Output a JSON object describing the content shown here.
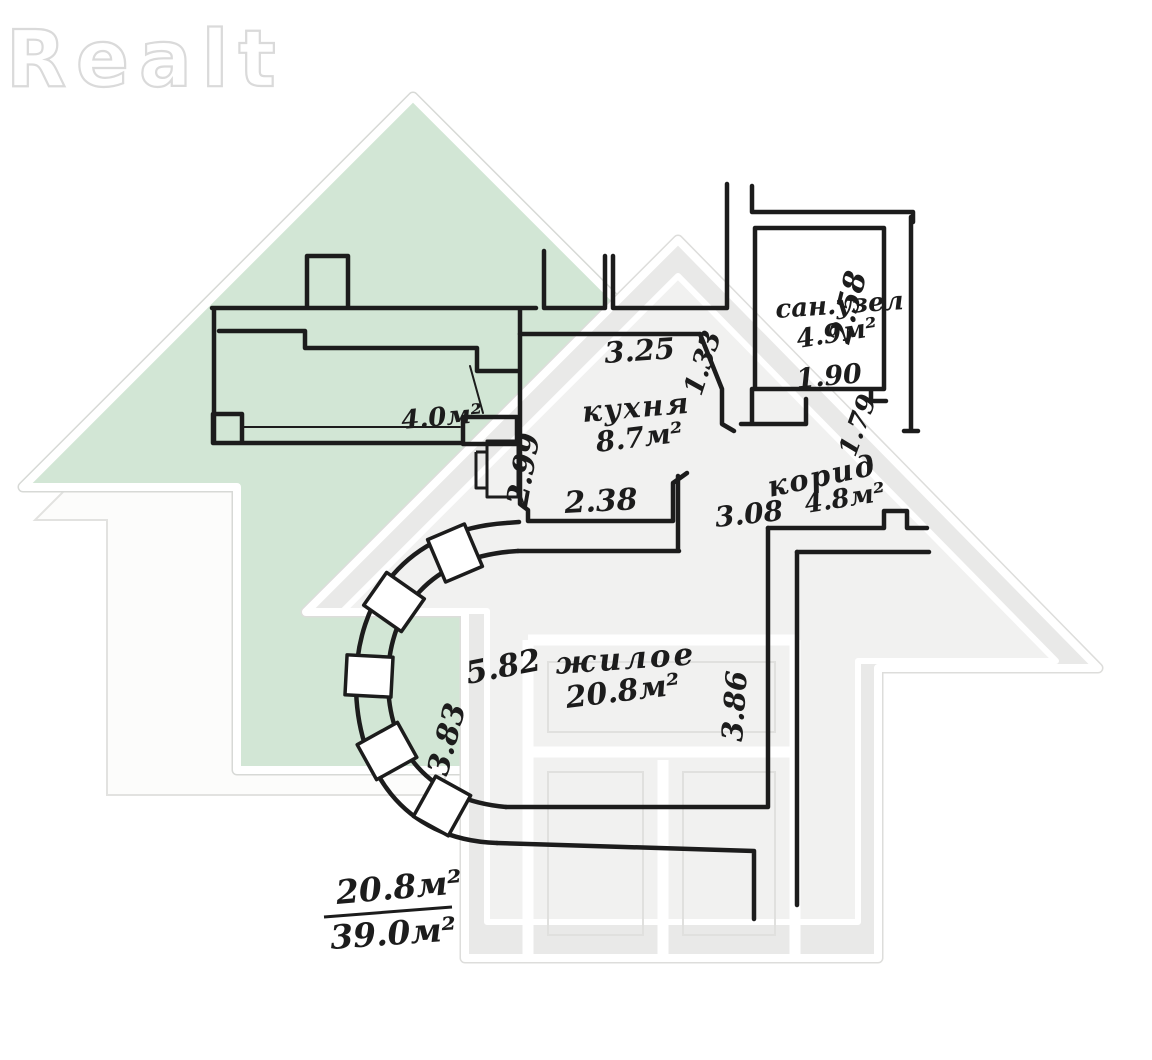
{
  "page": {
    "background": "#ffffff"
  },
  "watermark": {
    "logo_text": "Realt",
    "green_fill": "#d2e6d5",
    "gray_fill": "#e9e9e8",
    "gray_inner_fill": "#f1f1f0",
    "light_fill": "#fcfcfb"
  },
  "plan": {
    "ink_color": "#1c1c1c",
    "balcony": {
      "area": "4.0м²"
    },
    "kitchen": {
      "name": "кухня",
      "area": "8.7м²"
    },
    "bathroom": {
      "name": "сан.узел",
      "area": "4.9м²"
    },
    "corridor": {
      "name": "корид",
      "area": "4.8м²"
    },
    "living": {
      "name": "жилое",
      "area": "20.8м²"
    },
    "dimensions": {
      "top": "3.25",
      "kitchen_right": "1.33",
      "bath_height": "2.58",
      "bath_door": "1.90",
      "outer_right": "1.79",
      "kitchen_left": "2.99",
      "kitchen_bottom": "2.38",
      "corridor_width": "3.08",
      "living_width": "5.82",
      "bay_height": "3.83",
      "living_height": "3.86"
    },
    "totals": {
      "living": "20.8м²",
      "overall": "39.0м²"
    }
  }
}
